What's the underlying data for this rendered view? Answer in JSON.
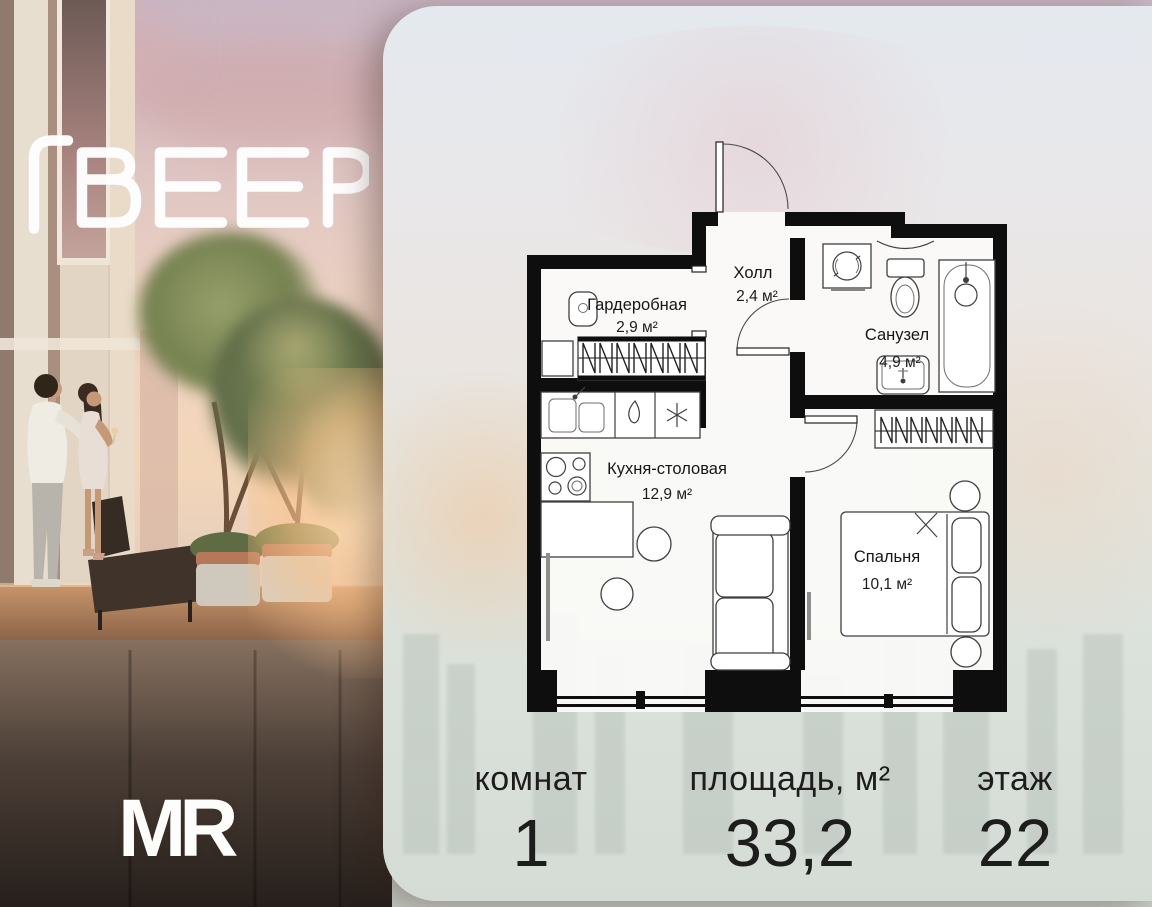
{
  "branding": {
    "veer_logo": "ВЕЕР",
    "mr_logo": "MR"
  },
  "floor_plan": {
    "rooms": [
      {
        "name": "Гардеробная",
        "area": "2,9 м²"
      },
      {
        "name": "Холл",
        "area": "2,4 м²"
      },
      {
        "name": "Санузел",
        "area": "4,9 м²"
      },
      {
        "name": "Кухня-столовая",
        "area": "12,9 м²"
      },
      {
        "name": "Спальня",
        "area": "10,1 м²"
      }
    ]
  },
  "specs": {
    "rooms": {
      "label": "комнат",
      "value": "1"
    },
    "area": {
      "label": "площадь, м²",
      "value": "33,2"
    },
    "floor": {
      "label": "этаж",
      "value": "22"
    }
  },
  "colors": {
    "plan_walls": "#0e0e0e",
    "panel_top": "#e4e9ef",
    "panel_bottom": "#d5dcd6",
    "logo": "#ffffff",
    "spec_text": "#1d1d1d"
  }
}
